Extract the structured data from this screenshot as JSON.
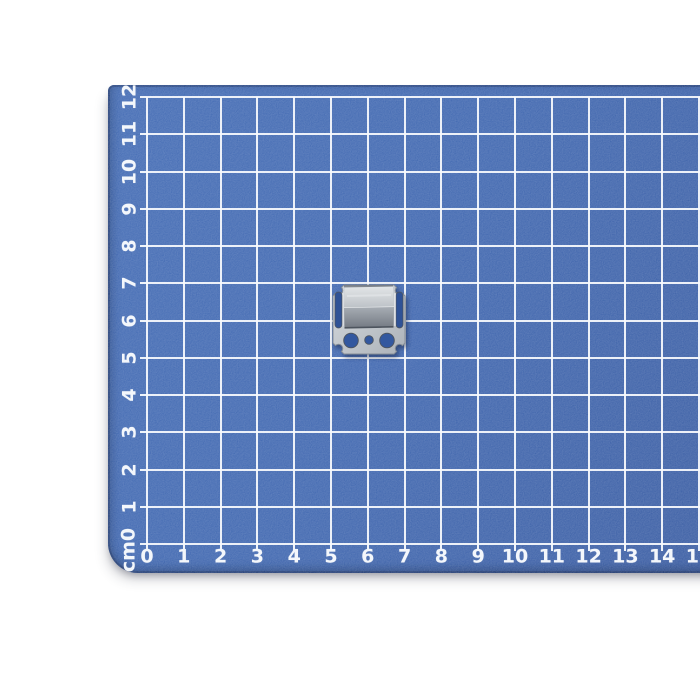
{
  "page": {
    "background_color": "#ffffff"
  },
  "mat": {
    "name": "blue self-healing cutting mat with centimeter grid",
    "unit_label": "cm",
    "corner_label": "cm0",
    "x_labels": [
      "0",
      "1",
      "2",
      "3",
      "4",
      "5",
      "6",
      "7",
      "8",
      "9",
      "10",
      "11",
      "12",
      "13",
      "14",
      "15"
    ],
    "y_labels": [
      "1",
      "2",
      "3",
      "4",
      "5",
      "6",
      "7",
      "8",
      "9",
      "10",
      "11",
      "12"
    ],
    "colors": {
      "base": "#3d65af",
      "edge": "#24467e",
      "grid_line": "#f7fafd",
      "label_text": "#f2f6fb"
    }
  },
  "object": {
    "name": "galvanized steel mounting clip with two slots, three holes and raised channel",
    "colors": {
      "plate_light": "#d6dade",
      "plate_mid": "#c2c7cc",
      "plate_dark": "#acb2b9",
      "box_top_light": "#e2e5e7",
      "box_top_dark": "#bcc1c6",
      "box_front_light": "#a7adb4",
      "box_front_dark": "#747a83",
      "hole_fill": "#33589f",
      "slot_fill": "#2f5296",
      "outline": "#878e97",
      "highlight": "#eef0f2",
      "shadow_line": "#4d545e"
    }
  }
}
